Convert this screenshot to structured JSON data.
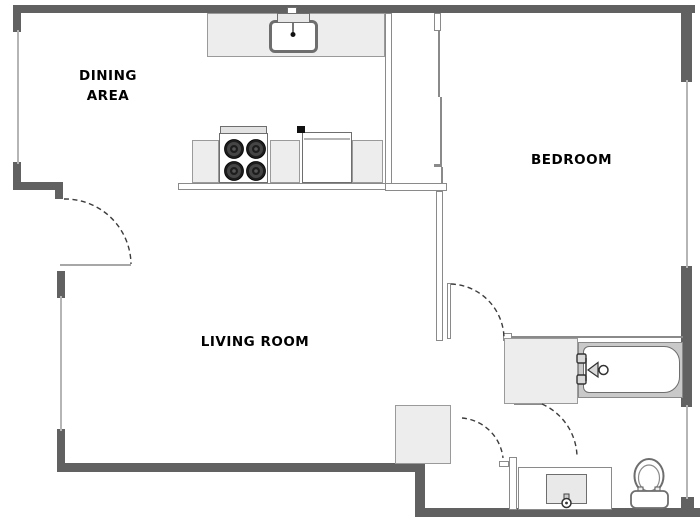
{
  "page": {
    "background": "#ffffff",
    "type": "apartment floor plan"
  },
  "labels": {
    "dining_line1": "DINING",
    "dining_line2": "AREA",
    "bedroom": "BEDROOM",
    "living_room": "LIVING ROOM"
  },
  "fixtures": [
    "kitchen-sink",
    "stove",
    "refrigerator",
    "kitchen-counters",
    "closet",
    "bathtub",
    "bathroom-vanity",
    "bathroom-sink",
    "toilet",
    "door-swing-arcs",
    "windows"
  ],
  "colors": {
    "exterior_wall": "#616161",
    "interior_wall_line": "#8a8a8a",
    "interior_wall_fill": "#ffffff",
    "counter_fill": "#ededed",
    "tub_deck_fill": "#c9c9c9",
    "window_line": "#b5b5b5",
    "fixture_outline": "#6e6e6e",
    "door_arc": "#3c3c3c",
    "burner": "#1d1d1d",
    "label_text": "#000000"
  }
}
